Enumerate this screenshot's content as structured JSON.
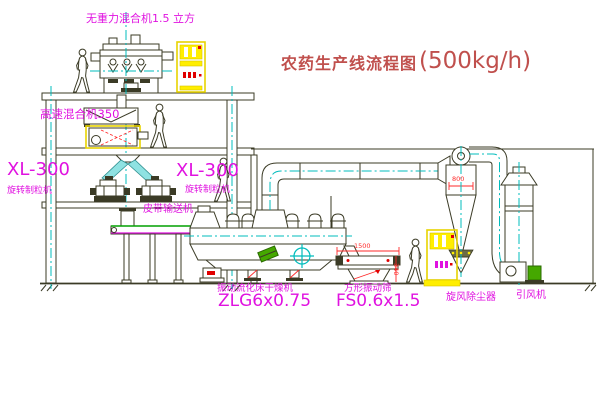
{
  "title": {
    "text": "农药生产线流程图",
    "capacity": "(500kg/h)"
  },
  "equipment": {
    "mixer_top": "无重力混合机1.5 立方",
    "mixer_second": "高速混合机350",
    "granulator_left_model": "XL-300",
    "granulator_left_name": "旋转制粒机",
    "granulator_right_model": "XL-300",
    "granulator_right_name": "旋转制粒机",
    "belt_conveyor": "皮带输送机",
    "dryer_name": "振动流化床干燥机",
    "dryer_model": "ZLG6x0.75",
    "screen_name": "方形振动筛",
    "screen_model": "FS0.6x1.5",
    "cyclone": "旋风除尘器",
    "fan": "引风机"
  },
  "dimensions": {
    "screen_length": "1500",
    "screen_height": "340",
    "cyclone_body": "800"
  },
  "colors": {
    "label": "#e012e0",
    "title": "#c0504d",
    "dimension": "#ff2a2a",
    "line": "#3b3b26",
    "centerline": "#00bcbc",
    "cabinet": "#ffee00",
    "motor": "#45a800"
  }
}
